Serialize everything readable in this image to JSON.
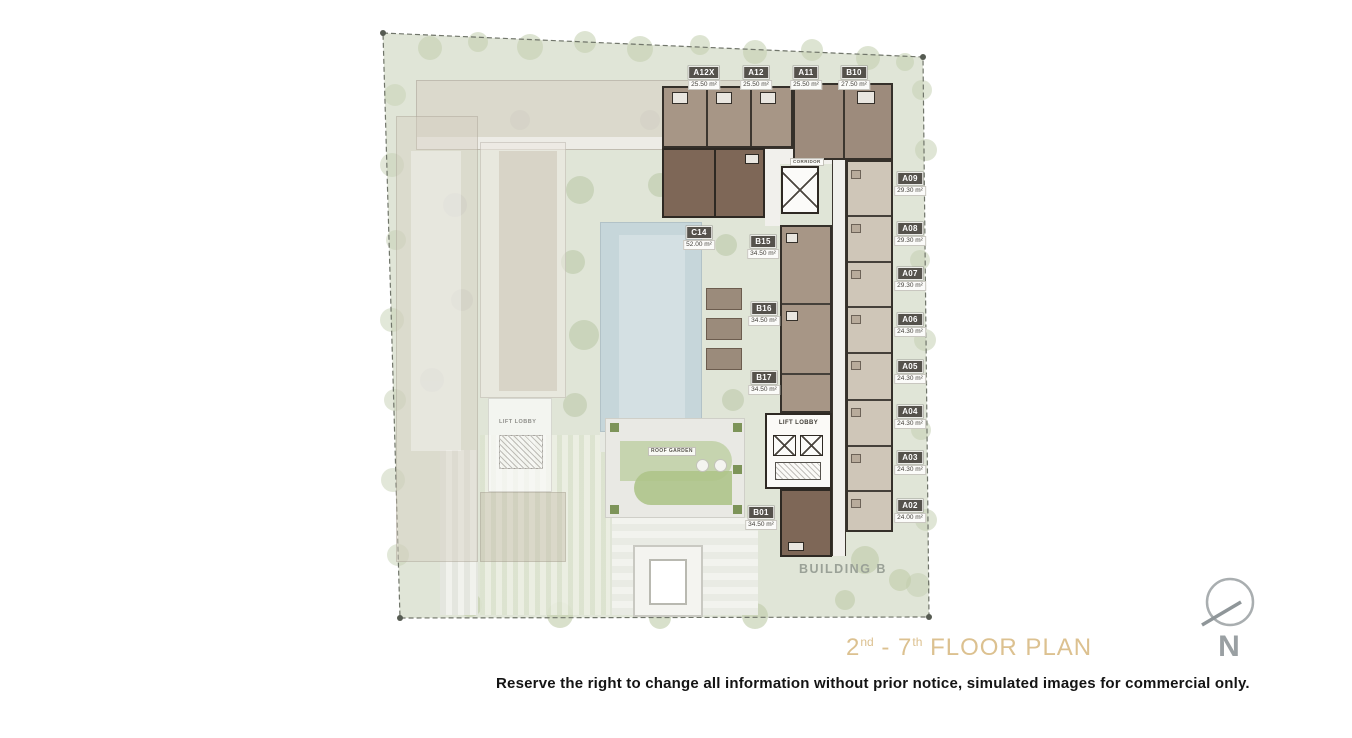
{
  "plan": {
    "building_label": "BUILDING B",
    "corridor_label": "CORRIDOR",
    "lift_lobby_label": "LIFT LOBBY",
    "lift_lobby_left_label": "LIFT LOBBY",
    "roof_garden_label": "ROOF GARDEN",
    "units": {
      "top_row": [
        {
          "id": "A12X",
          "area": "25.50 m²"
        },
        {
          "id": "A12",
          "area": "25.50 m²"
        },
        {
          "id": "A11",
          "area": "25.50 m²"
        },
        {
          "id": "B10",
          "area": "27.50 m²"
        }
      ],
      "right_column": [
        {
          "id": "A09",
          "area": "29.30 m²"
        },
        {
          "id": "A08",
          "area": "29.30 m²"
        },
        {
          "id": "A07",
          "area": "29.30 m²"
        },
        {
          "id": "A06",
          "area": "24.30 m²"
        },
        {
          "id": "A05",
          "area": "24.30 m²"
        },
        {
          "id": "A04",
          "area": "24.30 m²"
        },
        {
          "id": "A03",
          "area": "24.30 m²"
        },
        {
          "id": "A02",
          "area": "24.00 m²"
        }
      ],
      "inner": [
        {
          "id": "C14",
          "area": "52.00 m²"
        },
        {
          "id": "B15",
          "area": "34.50 m²"
        },
        {
          "id": "B16",
          "area": "34.50 m²"
        },
        {
          "id": "B17",
          "area": "34.50 m²"
        },
        {
          "id": "B01",
          "area": "34.50 m²"
        }
      ]
    }
  },
  "title": {
    "t1": "2",
    "s1": "nd",
    "t2": " - 7",
    "s2": "th",
    "t3": " FLOOR PLAN"
  },
  "compass": {
    "label": "N"
  },
  "disclaimer": "Reserve the right to change all information without prior notice, simulated images for commercial only.",
  "colors": {
    "title": "#dcc190",
    "site_green": "#e0e5d7",
    "unit_taupe": "#a79686",
    "unit_dark_brown": "#7e6757",
    "unit_light_beige": "#cfc6b8",
    "pool_blue": "#c6d6da",
    "badge_dark": "#55524c"
  }
}
